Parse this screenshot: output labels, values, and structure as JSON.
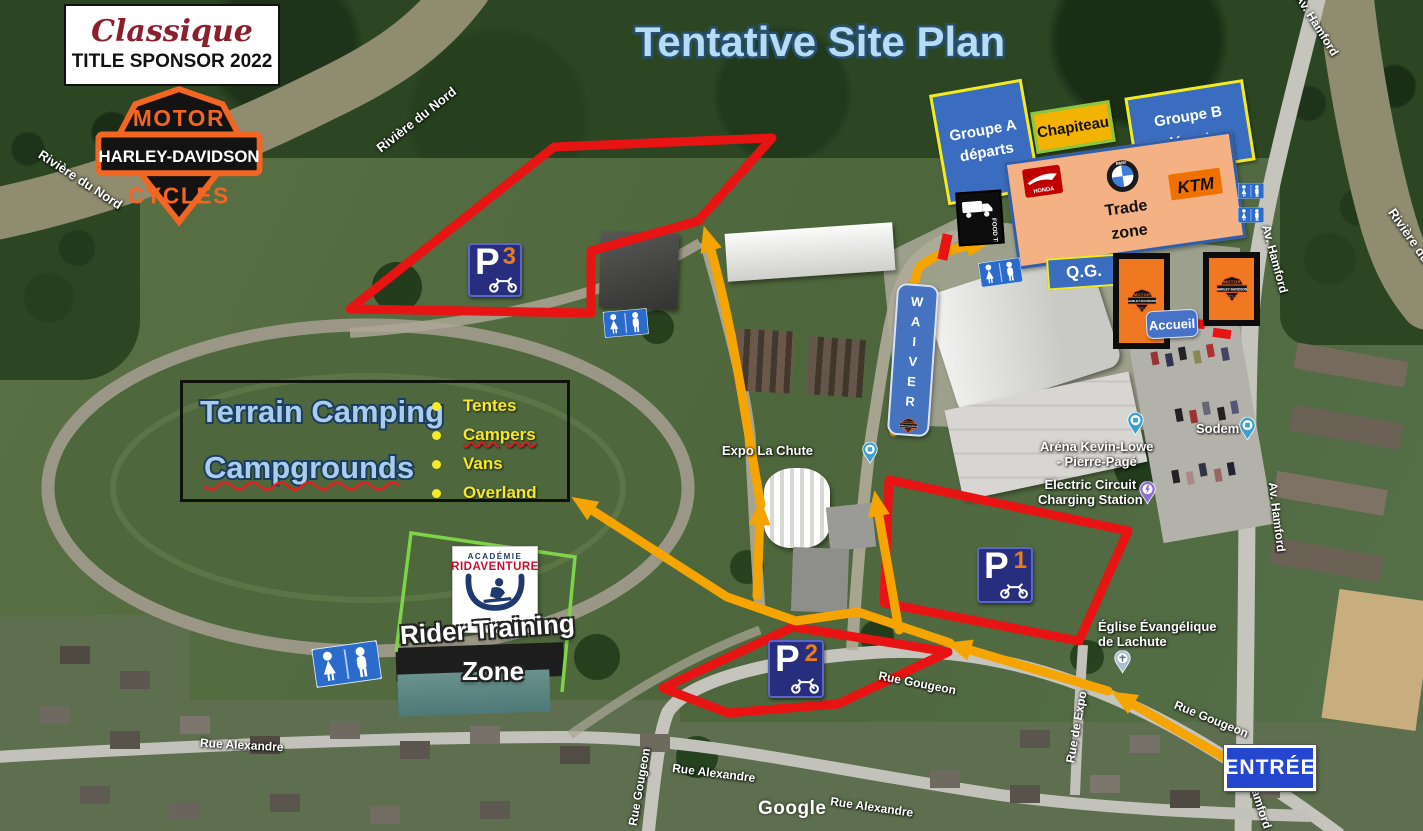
{
  "header": {
    "title": "Tentative Site Plan"
  },
  "sponsor": {
    "brand": "Classique",
    "label": "TITLE SPONSOR 2022"
  },
  "hd_logo": {
    "top": "MOTOR",
    "bar": "HARLEY-DAVIDSON",
    "bottom": "CYCLES"
  },
  "zones": {
    "groupe_a_line1": "Groupe A",
    "groupe_a_line2": "départs",
    "chapiteau": "Chapiteau",
    "groupe_b_line1": "Groupe B",
    "groupe_b_line2": "départs",
    "trade_line1": "Trade",
    "trade_line2": "zone",
    "qg": "Q.G.",
    "accueil": "Accueil",
    "waiver": "WAIVER",
    "entree": "ENTRÉE"
  },
  "camping": {
    "title_fr": "Terrain Camping",
    "title_en": "Campgrounds",
    "items": [
      "Tentes",
      "Campers",
      "Vans",
      "Overland"
    ]
  },
  "rider_zone": {
    "line1": "Rider Training",
    "line2": "Zone",
    "academy_top": "ACADÉMIE",
    "academy_name": "RIDAVENTURE"
  },
  "parking": {
    "p1": {
      "letter": "P",
      "number": "1"
    },
    "p2": {
      "letter": "P",
      "number": "2"
    },
    "p3": {
      "letter": "P",
      "number": "3"
    }
  },
  "vendors": {
    "honda": "HONDA",
    "bmw": "BMW",
    "ktm": "KTM",
    "food_truck": "FOOD TRUCK"
  },
  "map_pois": [
    {
      "text": "Expo La Chute"
    },
    {
      "line1": "Aréna Kevin-Lowe",
      "line2": "- Pierre-Pagé"
    },
    {
      "line1": "Electric Circuit",
      "line2": "Charging Station"
    },
    {
      "text": "Sodem"
    },
    {
      "line1": "Église Évangélique",
      "line2": "de Lachute"
    }
  ],
  "street_labels": [
    {
      "text": "Rivière du Nord"
    },
    {
      "text": "Rivière du Nord"
    },
    {
      "text": "Rivière du"
    },
    {
      "text": "Av. Hamford"
    },
    {
      "text": "Av. Hamford"
    },
    {
      "text": "Av. Hamford"
    },
    {
      "text": "Av. Hamford"
    },
    {
      "text": "Rue Gougeon"
    },
    {
      "text": "Rue Gougeon"
    },
    {
      "text": "Rue Gougeon"
    },
    {
      "text": "Rue Alexandre"
    },
    {
      "text": "Rue Alexandre"
    },
    {
      "text": "Rue Alexandre"
    },
    {
      "text": "Rue de Expo"
    }
  ],
  "watermark": {
    "text": "Google"
  },
  "colors": {
    "route_arrow": "#f6a400",
    "route_closed": "#e81313",
    "parking_sign_bg": "#272e7d",
    "parking_number": "#e87c1e",
    "zone_blue": "#3a6dbf",
    "zone_yellow_border": "#f3ea1f",
    "chapiteau_bg": "#f2b303",
    "trade_bg": "#f4b183",
    "trade_border": "#2e5fac",
    "entree_bg": "#2547d0",
    "hd_orange": "#f26522",
    "rider_border_green": "#7ed348",
    "title_fill": "#b7dcf5",
    "camping_item_yellow": "#f5e92a"
  }
}
